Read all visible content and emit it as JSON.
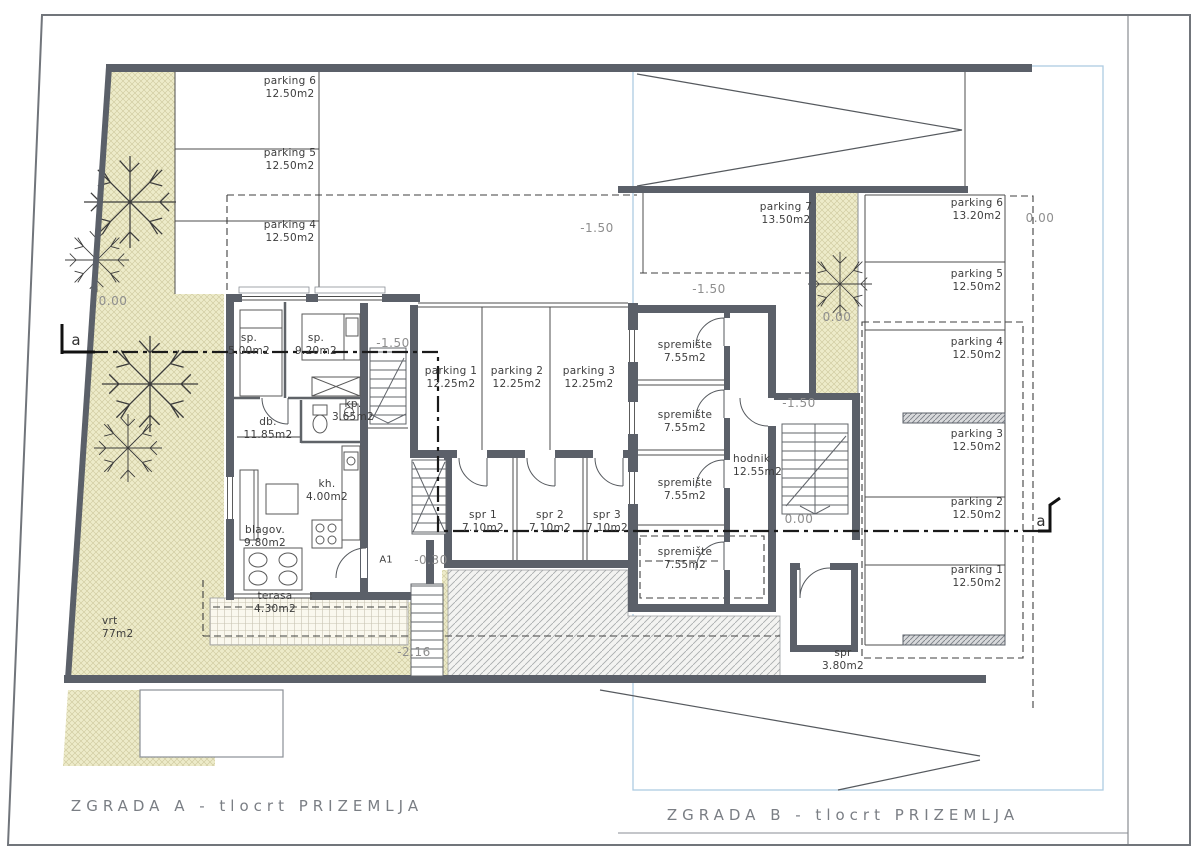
{
  "titles": {
    "building_a": "ZGRADA A - tlocrt PRIZEMLJA",
    "building_b": "ZGRADA B - tlocrt PRIZEMLJA"
  },
  "section": {
    "marker_left": "a",
    "marker_right": "a"
  },
  "building_a": {
    "parking_row": [
      {
        "name": "parking 6",
        "area": "12.50m2"
      },
      {
        "name": "parking 5",
        "area": "12.50m2"
      },
      {
        "name": "parking 4",
        "area": "12.50m2"
      }
    ],
    "garage": [
      {
        "name": "parking 1",
        "area": "12.25m2"
      },
      {
        "name": "parking 2",
        "area": "12.25m2"
      },
      {
        "name": "parking 3",
        "area": "12.25m2"
      }
    ],
    "storage": [
      {
        "name": "spr 1",
        "area": "7.10m2"
      },
      {
        "name": "spr 2",
        "area": "7.10m2"
      },
      {
        "name": "spr 3",
        "area": "7.10m2"
      }
    ],
    "rooms": {
      "bedroom1": {
        "name": "sp.",
        "area": "5.00m2"
      },
      "bedroom2": {
        "name": "sp.",
        "area": "9.20m2"
      },
      "living": {
        "name": "db.",
        "area": "11.85m2"
      },
      "bath": {
        "name": "kp.",
        "area": "3.65m2"
      },
      "kitchen": {
        "name": "kh.",
        "area": "4.00m2"
      },
      "dining": {
        "name": "blagov.",
        "area": "9.80m2"
      },
      "terrace": {
        "name": "terasa",
        "area": "4.30m2"
      },
      "garden": {
        "name": "vrt",
        "area": "77m2"
      }
    },
    "door_tag": "A1",
    "levels": {
      "garden": "0.00",
      "upper": "-1.50",
      "stairs": "-1.50",
      "entry": "-0.30",
      "ramp": "-2.16"
    }
  },
  "building_b": {
    "parking7": {
      "name": "parking 7",
      "area": "13.50m2"
    },
    "storage": [
      {
        "name": "spremište",
        "area": "7.55m2"
      },
      {
        "name": "spremište",
        "area": "7.55m2"
      },
      {
        "name": "spremište",
        "area": "7.55m2"
      },
      {
        "name": "spremište",
        "area": "7.55m2"
      }
    ],
    "corridor": {
      "name": "hodnik",
      "area": "12.55m2"
    },
    "spr": {
      "name": "spr",
      "area": "3.80m2"
    },
    "parking_row": [
      {
        "name": "parking 6",
        "area": "13.20m2"
      },
      {
        "name": "parking 5",
        "area": "12.50m2"
      },
      {
        "name": "parking 4",
        "area": "12.50m2"
      },
      {
        "name": "parking 3",
        "area": "12.50m2"
      },
      {
        "name": "parking 2",
        "area": "12.50m2"
      },
      {
        "name": "parking 1",
        "area": "12.50m2"
      }
    ],
    "levels": {
      "p7": "-1.50",
      "strip": "0.00",
      "stairs_top": "-1.50",
      "stairs_bottom": "0.00",
      "right": "0.00"
    }
  }
}
